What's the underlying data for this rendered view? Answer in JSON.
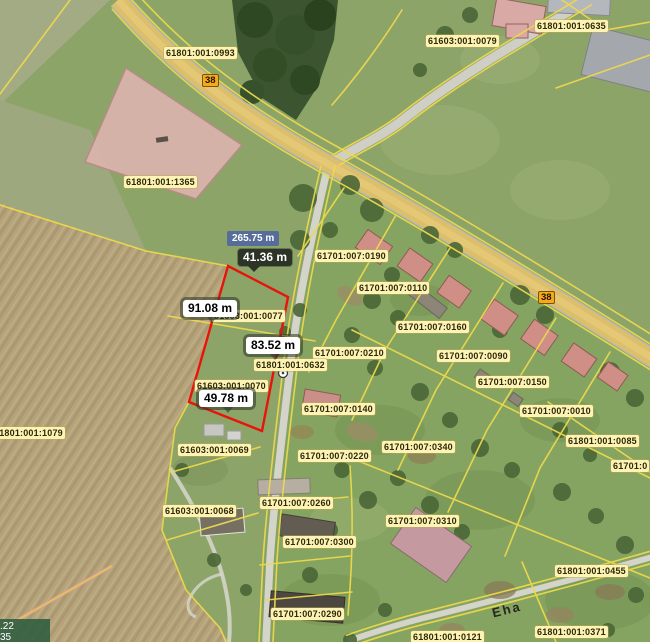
{
  "colors": {
    "boundary_yellow": "#ecd84d",
    "highlight_red": "#e8140a",
    "label_bg": "#fdf3b6",
    "road_badge_bg": "#f7a81c",
    "measure_total_bg": "#566c99",
    "measure_dark_bg": "#2c3428",
    "road_fill": "#ddbe6b"
  },
  "parcel_labels": [
    {
      "text": "61801:001:0993",
      "x": 164,
      "y": 47
    },
    {
      "text": "61603:001:0079",
      "x": 426,
      "y": 35
    },
    {
      "text": "61801:001:0635",
      "x": 535,
      "y": 20
    },
    {
      "text": "61801:001:1365",
      "x": 124,
      "y": 176
    },
    {
      "text": "61701:007:0190",
      "x": 315,
      "y": 250
    },
    {
      "text": "61701:007:0110",
      "x": 357,
      "y": 282
    },
    {
      "text": "61603:001:0077",
      "x": 212,
      "y": 310
    },
    {
      "text": "61701:007:0160",
      "x": 396,
      "y": 321
    },
    {
      "text": "61701:007:0210",
      "x": 313,
      "y": 347
    },
    {
      "text": "61701:007:0090",
      "x": 437,
      "y": 350
    },
    {
      "text": "61801:001:0632",
      "x": 254,
      "y": 359
    },
    {
      "text": "61603:001:0070",
      "x": 195,
      "y": 380
    },
    {
      "text": "61701:007:0150",
      "x": 476,
      "y": 376
    },
    {
      "text": "61701:007:0140",
      "x": 302,
      "y": 403
    },
    {
      "text": "61701:007:0010",
      "x": 520,
      "y": 405
    },
    {
      "text": "61801:001:1079",
      "x": -8,
      "y": 427
    },
    {
      "text": "61801:001:0085",
      "x": 566,
      "y": 435
    },
    {
      "text": "61701:007:0340",
      "x": 382,
      "y": 441
    },
    {
      "text": "61603:001:0069",
      "x": 178,
      "y": 444
    },
    {
      "text": "61701:007:0220",
      "x": 298,
      "y": 450
    },
    {
      "text": "61701:0",
      "x": 611,
      "y": 460
    },
    {
      "text": "61701:007:0260",
      "x": 260,
      "y": 497
    },
    {
      "text": "61603:001:0068",
      "x": 163,
      "y": 505
    },
    {
      "text": "61701:007:0310",
      "x": 386,
      "y": 515
    },
    {
      "text": "61701:007:0300",
      "x": 283,
      "y": 536
    },
    {
      "text": "61801:001:0455",
      "x": 555,
      "y": 565
    },
    {
      "text": "61701:007:0290",
      "x": 271,
      "y": 608
    },
    {
      "text": "61801:001:0371",
      "x": 535,
      "y": 626
    },
    {
      "text": "61801:001:0121",
      "x": 411,
      "y": 631
    }
  ],
  "road_badges": [
    {
      "text": "38",
      "x": 202,
      "y": 74
    },
    {
      "text": "38",
      "x": 538,
      "y": 291
    }
  ],
  "street_label": {
    "text": "Eha",
    "x": 492,
    "y": 603,
    "rotation": -14
  },
  "measurements": {
    "total": {
      "text": "265.75 m",
      "x": 227,
      "y": 231
    },
    "segments": [
      {
        "text": "41.36 m",
        "x": 238,
        "y": 249,
        "style": "dark"
      },
      {
        "text": "91.08 m",
        "x": 183,
        "y": 300,
        "style": "light"
      },
      {
        "text": "83.52 m",
        "x": 246,
        "y": 337,
        "style": "light"
      },
      {
        "text": "49.78 m",
        "x": 199,
        "y": 390,
        "style": "light"
      }
    ]
  },
  "coordinate_overlay": {
    "line1": ".22",
    "line2": "35"
  }
}
